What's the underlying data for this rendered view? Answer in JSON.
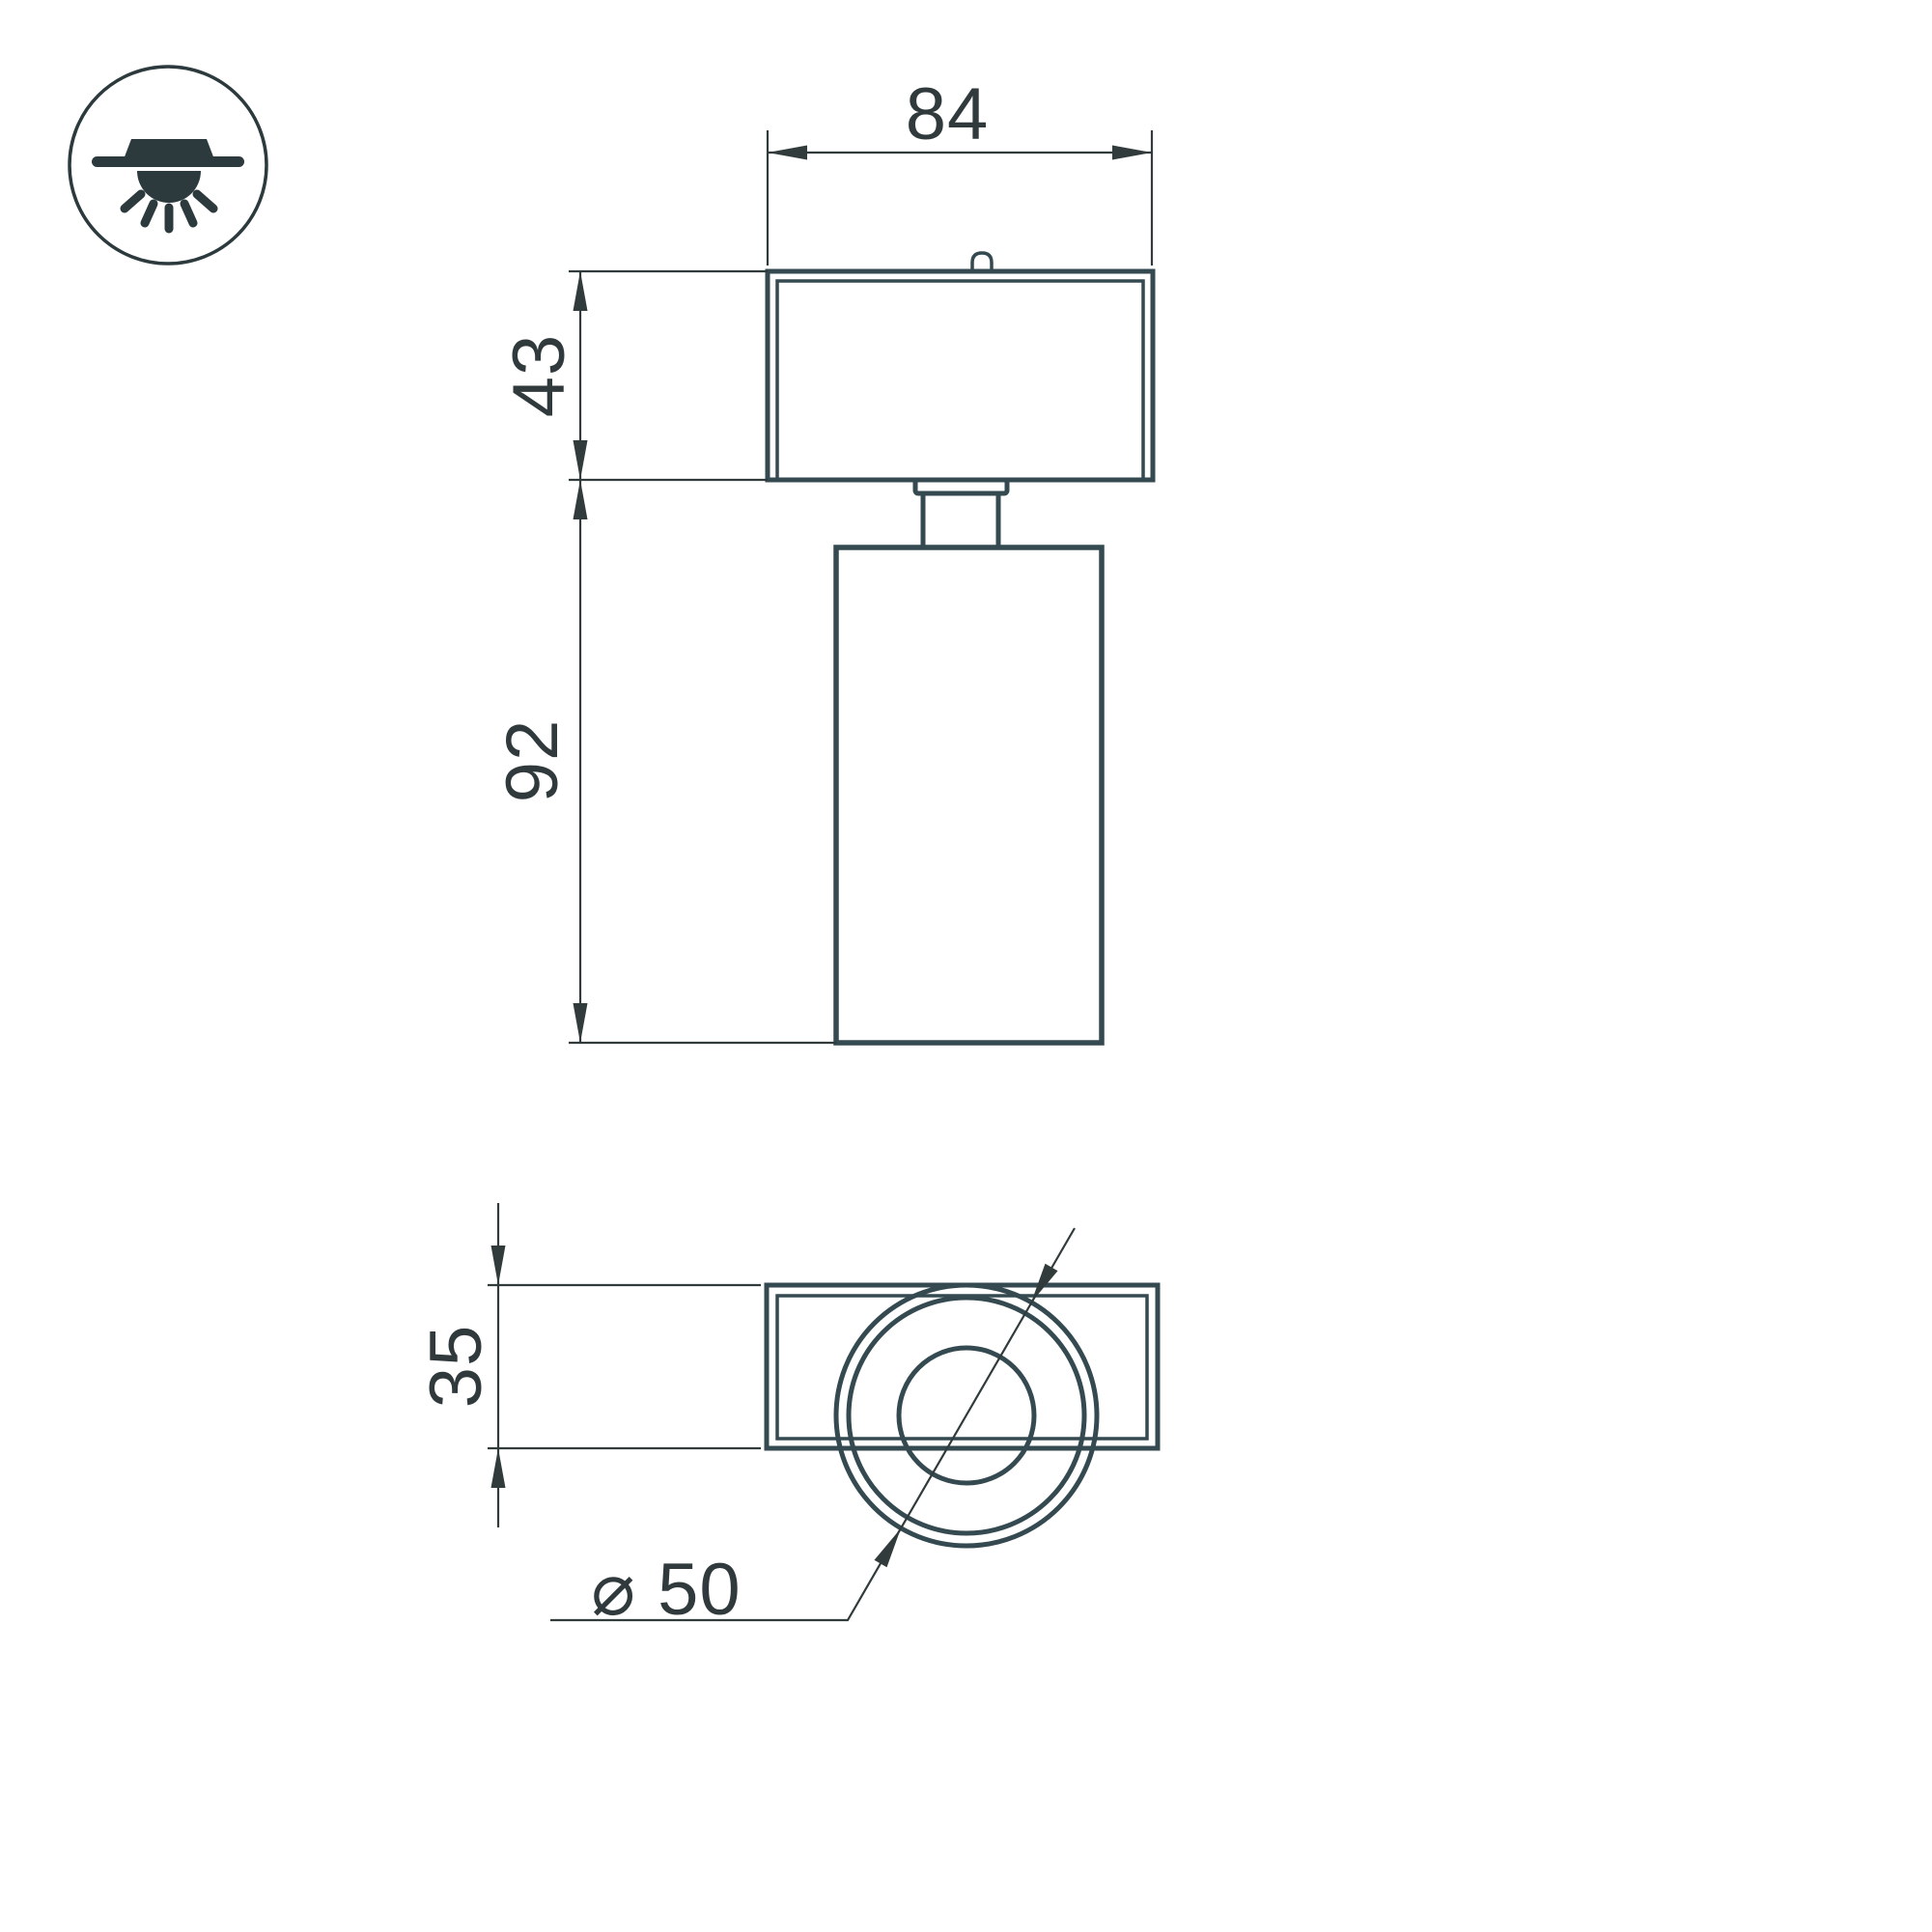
{
  "drawing": {
    "icon": {
      "name": "surface-mounted-ceiling-light-icon"
    },
    "front_view": {
      "width_mm": "84",
      "head_height_mm": "43",
      "body_height_mm": "92"
    },
    "bottom_view": {
      "depth_mm": "35",
      "diameter_label": "⌀ 50"
    },
    "colors": {
      "outline": "#344a50",
      "dimension": "#323b3c",
      "text": "#30393b",
      "icon": "#2c3a3e",
      "background": "#ffffff"
    }
  }
}
